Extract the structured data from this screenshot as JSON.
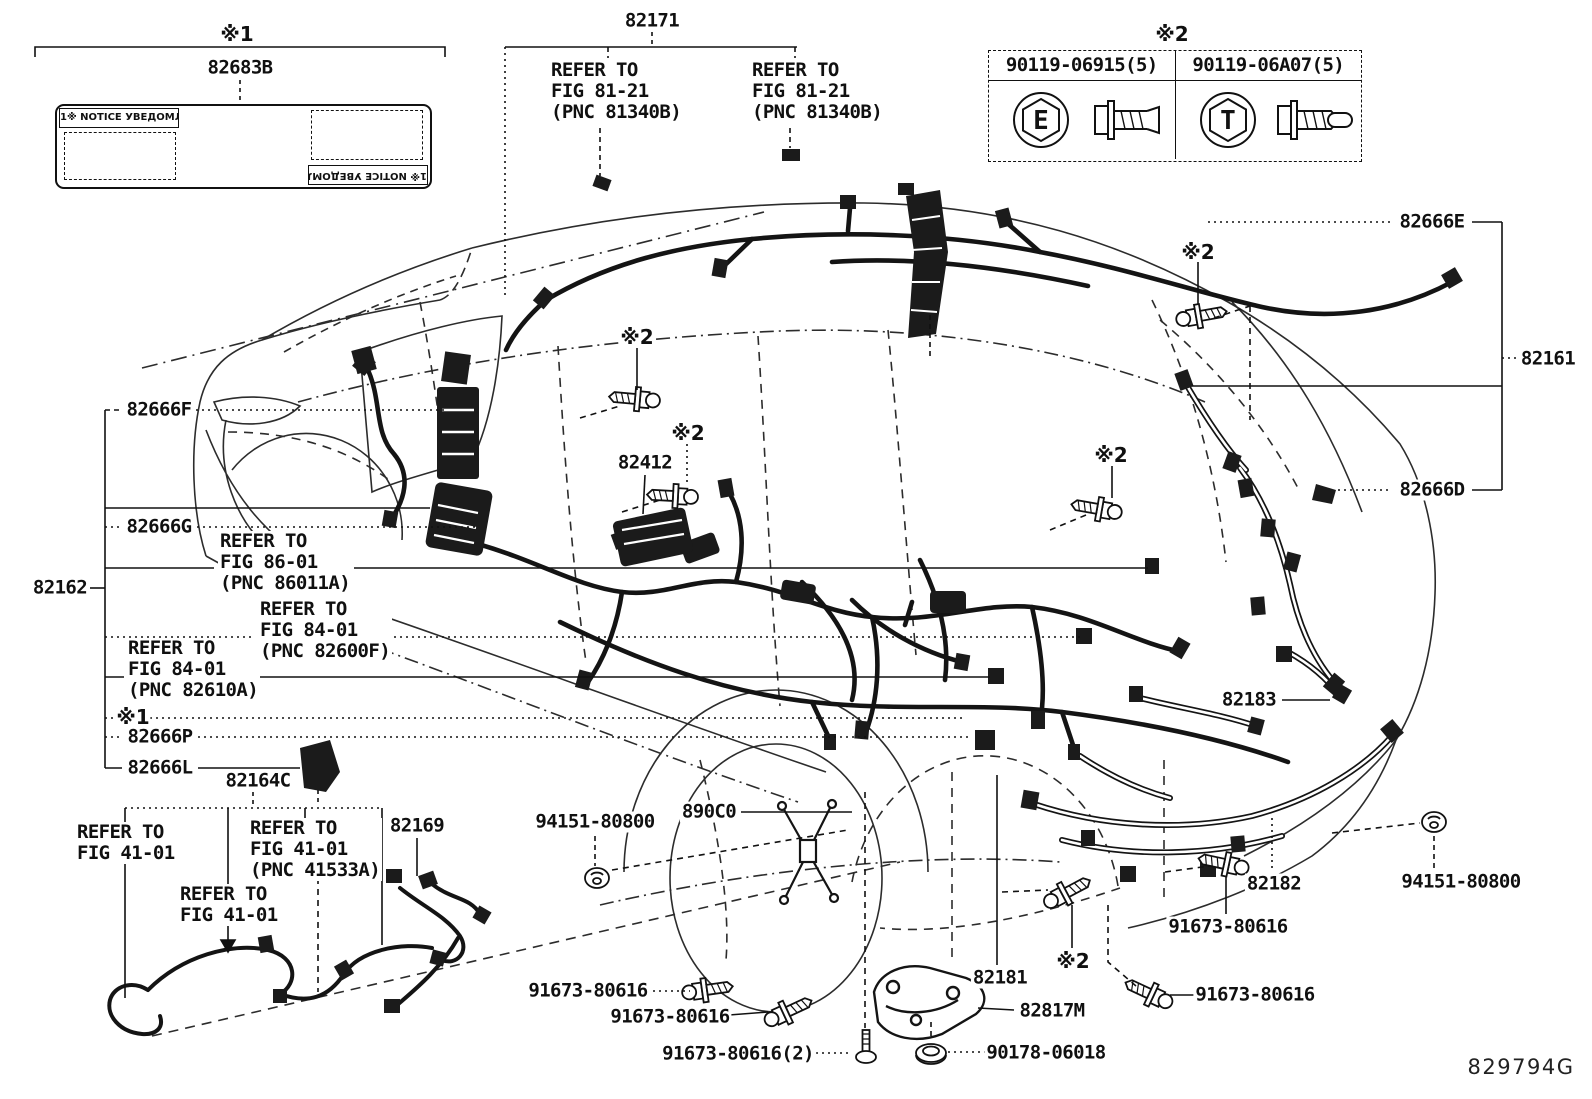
{
  "figure": {
    "code": "829794G"
  },
  "top_left_ref": {
    "mark": "※1",
    "part": "82683B",
    "notice_header": "1※ NOTICE УВЕДОМЛЕНИЕ"
  },
  "fastener_table": {
    "mark": "※2",
    "items": [
      {
        "part": "90119-06915(5)",
        "face_letter": "E"
      },
      {
        "part": "90119-06A07(5)",
        "face_letter": "T"
      }
    ]
  },
  "callouts": [
    {
      "name": "mark-x1-top",
      "text": "※1",
      "x": 237,
      "y": 34,
      "cls": "mark"
    },
    {
      "name": "label-82683b",
      "text": "82683B",
      "x": 240,
      "y": 68,
      "cls": "pn"
    },
    {
      "name": "label-82171",
      "text": "82171",
      "x": 652,
      "y": 21,
      "cls": "pn"
    },
    {
      "name": "ref-fig81-21-a",
      "text": "REFER TO\nFIG 81-21\n(PNC 81340B)",
      "x": 549,
      "y": 60,
      "cls": "pn",
      "anchor": "tl"
    },
    {
      "name": "ref-fig81-21-b",
      "text": "REFER TO\nFIG 81-21\n(PNC 81340B)",
      "x": 750,
      "y": 60,
      "cls": "pn",
      "anchor": "tl"
    },
    {
      "name": "mark-x2-table",
      "text": "※2",
      "x": 1172,
      "y": 34,
      "cls": "mark"
    },
    {
      "name": "label-82666e",
      "text": "82666E",
      "x": 1432,
      "y": 222,
      "cls": "pn"
    },
    {
      "name": "label-82161",
      "text": "82161",
      "x": 1548,
      "y": 359,
      "cls": "pn"
    },
    {
      "name": "label-82666d",
      "text": "82666D",
      "x": 1432,
      "y": 490,
      "cls": "pn"
    },
    {
      "name": "label-82666f",
      "text": "82666F",
      "x": 159,
      "y": 410,
      "cls": "pn"
    },
    {
      "name": "label-82666g",
      "text": "82666G",
      "x": 159,
      "y": 527,
      "cls": "pn"
    },
    {
      "name": "label-82162",
      "text": "82162",
      "x": 60,
      "y": 588,
      "cls": "pn"
    },
    {
      "name": "ref-fig86-01",
      "text": "REFER TO\nFIG 86-01\n(PNC 86011A)",
      "x": 218,
      "y": 531,
      "cls": "pn",
      "anchor": "tl"
    },
    {
      "name": "ref-fig84-01-82600f",
      "text": "REFER TO\nFIG 84-01\n(PNC 82600F)",
      "x": 258,
      "y": 599,
      "cls": "pn",
      "anchor": "tl"
    },
    {
      "name": "ref-fig84-01-82610a",
      "text": "REFER TO\nFIG 84-01\n(PNC 82610A)",
      "x": 126,
      "y": 638,
      "cls": "pn",
      "anchor": "tl"
    },
    {
      "name": "mark-x1-left",
      "text": "※1",
      "x": 133,
      "y": 717,
      "cls": "mark"
    },
    {
      "name": "label-82666p",
      "text": "82666P",
      "x": 160,
      "y": 737,
      "cls": "pn"
    },
    {
      "name": "label-82666l",
      "text": "82666L",
      "x": 160,
      "y": 768,
      "cls": "pn"
    },
    {
      "name": "label-82164c",
      "text": "82164C",
      "x": 258,
      "y": 781,
      "cls": "pn"
    },
    {
      "name": "ref-fig41-01-a",
      "text": "REFER TO\nFIG 41-01",
      "x": 75,
      "y": 822,
      "cls": "pn",
      "anchor": "tl"
    },
    {
      "name": "ref-fig41-01-pnc41533a",
      "text": "REFER TO\nFIG 41-01\n(PNC 41533A)",
      "x": 248,
      "y": 818,
      "cls": "pn",
      "anchor": "tl"
    },
    {
      "name": "ref-fig41-01-b",
      "text": "REFER TO\nFIG 41-01",
      "x": 178,
      "y": 884,
      "cls": "pn",
      "anchor": "tl"
    },
    {
      "name": "label-82169",
      "text": "82169",
      "x": 417,
      "y": 826,
      "cls": "pn"
    },
    {
      "name": "mark-x2-cowl",
      "text": "※2",
      "x": 637,
      "y": 337,
      "cls": "mark"
    },
    {
      "name": "mark-x2-floor",
      "text": "※2",
      "x": 688,
      "y": 433,
      "cls": "mark"
    },
    {
      "name": "label-82412",
      "text": "82412",
      "x": 645,
      "y": 463,
      "cls": "pn"
    },
    {
      "name": "mark-x2-roof",
      "text": "※2",
      "x": 1198,
      "y": 252,
      "cls": "mark"
    },
    {
      "name": "mark-x2-rear",
      "text": "※2",
      "x": 1111,
      "y": 455,
      "cls": "mark"
    },
    {
      "name": "label-94151-80800-left",
      "text": "94151-80800",
      "x": 595,
      "y": 822,
      "cls": "pn"
    },
    {
      "name": "label-890c0",
      "text": "890C0",
      "x": 709,
      "y": 812,
      "cls": "pn"
    },
    {
      "name": "label-82183",
      "text": "82183",
      "x": 1249,
      "y": 700,
      "cls": "pn"
    },
    {
      "name": "label-82182",
      "text": "82182",
      "x": 1274,
      "y": 884,
      "cls": "pn"
    },
    {
      "name": "label-91673-80616-a",
      "text": "91673-80616",
      "x": 588,
      "y": 991,
      "cls": "pn"
    },
    {
      "name": "label-91673-80616-b",
      "text": "91673-80616",
      "x": 670,
      "y": 1017,
      "cls": "pn"
    },
    {
      "name": "label-91673-80616-c",
      "text": "91673-80616(2)",
      "x": 738,
      "y": 1054,
      "cls": "pn"
    },
    {
      "name": "label-90178-06018",
      "text": "90178-06018",
      "x": 1046,
      "y": 1053,
      "cls": "pn"
    },
    {
      "name": "label-82817m",
      "text": "82817M",
      "x": 1052,
      "y": 1011,
      "cls": "pn"
    },
    {
      "name": "label-82181",
      "text": "82181",
      "x": 1000,
      "y": 978,
      "cls": "pn"
    },
    {
      "name": "label-91673-80616-d",
      "text": "91673-80616",
      "x": 1228,
      "y": 927,
      "cls": "pn"
    },
    {
      "name": "label-94151-80800-right",
      "text": "94151-80800",
      "x": 1461,
      "y": 882,
      "cls": "pn"
    },
    {
      "name": "label-91673-80616-e",
      "text": "91673-80616",
      "x": 1255,
      "y": 995,
      "cls": "pn"
    },
    {
      "name": "mark-x2-bumper",
      "text": "※2",
      "x": 1073,
      "y": 961,
      "cls": "mark"
    },
    {
      "name": "figure-code",
      "text": "829794G",
      "x": 1521,
      "y": 1067,
      "cls": "fig"
    }
  ]
}
